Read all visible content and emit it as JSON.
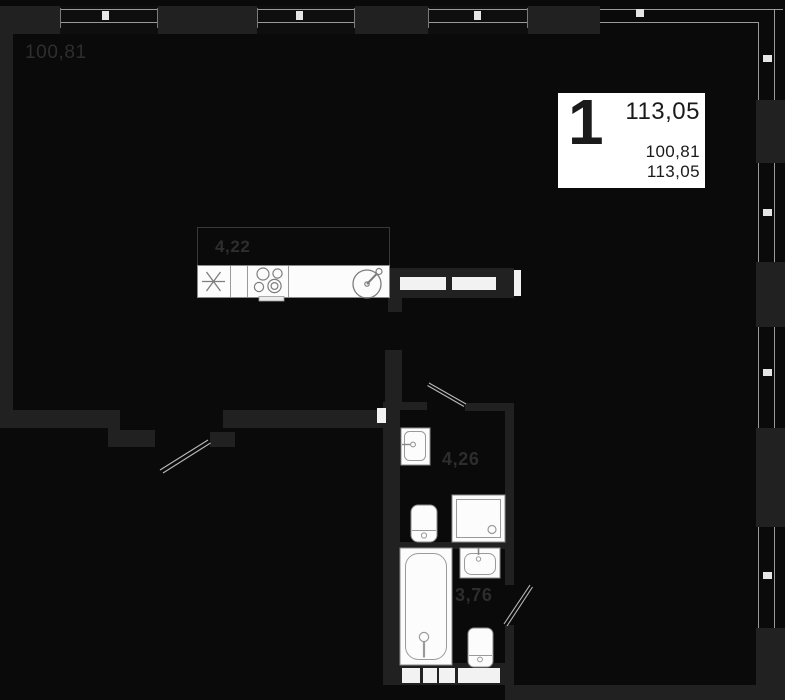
{
  "floorplan": {
    "labels": {
      "main_room_area": "100,81",
      "kitchen_area": "4,22",
      "bathroom_area": "4,26",
      "bathroom2_area": "3,76"
    },
    "info_card": {
      "rooms": "1",
      "area_main": "113,05",
      "area_living": "100,81",
      "area_total": "113,05"
    },
    "colors": {
      "background": "#0a0a0a",
      "wall": "#212121",
      "fixture_fill": "#fcfcfc",
      "fixture_stroke": "#8a8a8a",
      "glazing_line": "#9a9a9a",
      "tick": "#e5e5e5",
      "label_text": "#2e2e2e",
      "card_bg": "#ffffff",
      "card_text": "#1a1a1a"
    },
    "fixtures": [
      "kitchen-sink",
      "stove",
      "round-sink",
      "washbasin",
      "toilet",
      "shower-tray",
      "bathtub",
      "washbasin-2",
      "toilet-2"
    ]
  }
}
